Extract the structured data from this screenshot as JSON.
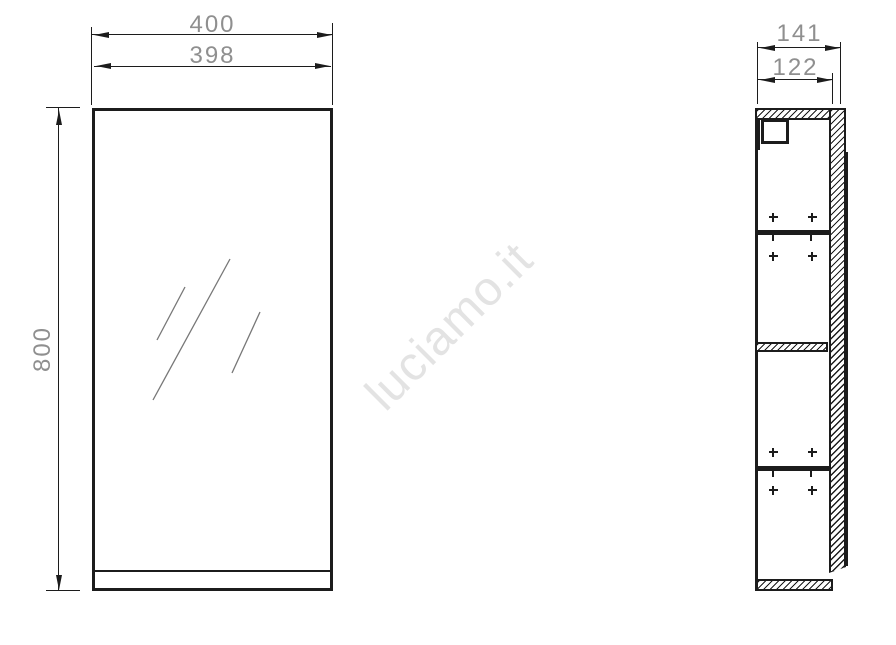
{
  "watermark": {
    "text": "luciamo.it"
  },
  "front_view": {
    "description": "mirror cabinet front elevation",
    "dims": {
      "outer_width": "400",
      "mirror_width": "398",
      "height": "800"
    }
  },
  "side_view": {
    "description": "mirror cabinet side section",
    "dims": {
      "total_depth": "141",
      "carcass_depth": "122"
    }
  },
  "colors": {
    "line": "#1c1c1c",
    "dim_text": "#8f8f8f",
    "watermark": "#e3e3e3",
    "glass_line": "#777777"
  }
}
